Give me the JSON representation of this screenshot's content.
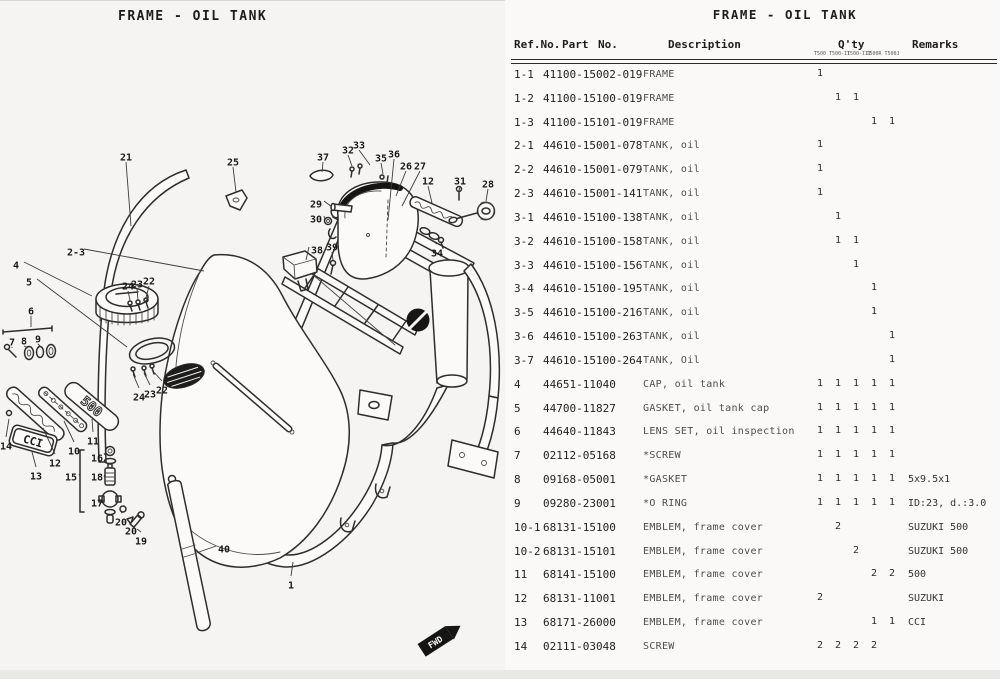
{
  "diagram": {
    "title": "FRAME - OIL TANK",
    "fwd_label": "FWD",
    "emblems": {
      "plate_500": "500",
      "plate_cci": "CCI"
    },
    "callouts": [
      {
        "label": "21",
        "x": 126,
        "y": 157,
        "tx": 131,
        "ty": 226
      },
      {
        "label": "25",
        "x": 233,
        "y": 162,
        "tx": 236,
        "ty": 192
      },
      {
        "label": "37",
        "x": 323,
        "y": 157,
        "tx": 322,
        "ty": 172
      },
      {
        "label": "32",
        "x": 348,
        "y": 150,
        "tx": 352,
        "ty": 166
      },
      {
        "label": "33",
        "x": 359,
        "y": 145,
        "tx": 370,
        "ty": 165
      },
      {
        "label": "35",
        "x": 381,
        "y": 158,
        "tx": 383,
        "ty": 174
      },
      {
        "label": "36",
        "x": 394,
        "y": 154,
        "tx": 388,
        "ty": 220
      },
      {
        "label": "26",
        "x": 406,
        "y": 166,
        "tx": 396,
        "ty": 196
      },
      {
        "label": "27",
        "x": 420,
        "y": 166,
        "tx": 402,
        "ty": 206
      },
      {
        "label": "12",
        "x": 428,
        "y": 181,
        "tx": 432,
        "ty": 203
      },
      {
        "label": "31",
        "x": 460,
        "y": 181,
        "tx": 459,
        "ty": 191
      },
      {
        "label": "28",
        "x": 488,
        "y": 184,
        "tx": 486,
        "ty": 201
      },
      {
        "label": "29",
        "x": 316,
        "y": 204,
        "tx": 332,
        "ty": 207
      },
      {
        "label": "30",
        "x": 316,
        "y": 219,
        "tx": 325,
        "ty": 220
      },
      {
        "label": "38",
        "x": 317,
        "y": 250,
        "tx": 306,
        "ty": 260
      },
      {
        "label": "39",
        "x": 332,
        "y": 247,
        "tx": 333,
        "ty": 260
      },
      {
        "label": "34",
        "x": 437,
        "y": 253,
        "tx": 431,
        "ty": 240
      },
      {
        "label": "2-3",
        "x": 76,
        "y": 252,
        "tx": 204,
        "ty": 271
      },
      {
        "label": "4",
        "x": 16,
        "y": 265,
        "tx": 92,
        "ty": 296
      },
      {
        "label": "5",
        "x": 29,
        "y": 282,
        "tx": 127,
        "ty": 347
      },
      {
        "label": "24",
        "x": 128,
        "y": 286,
        "tx": 130,
        "ty": 300
      },
      {
        "label": "23",
        "x": 137,
        "y": 284,
        "tx": 138,
        "ty": 300
      },
      {
        "label": "22",
        "x": 149,
        "y": 281,
        "tx": 146,
        "ty": 298
      },
      {
        "label": "6",
        "x": 31,
        "y": 311,
        "tx": 31,
        "ty": 327
      },
      {
        "label": "7",
        "x": 12,
        "y": 342,
        "tx": 12,
        "ty": 348
      },
      {
        "label": "8",
        "x": 24,
        "y": 341,
        "tx": 28,
        "ty": 348
      },
      {
        "label": "9",
        "x": 38,
        "y": 339,
        "tx": 41,
        "ty": 347
      },
      {
        "label": "24",
        "x": 139,
        "y": 397,
        "tx": 133,
        "ty": 374
      },
      {
        "label": "23",
        "x": 150,
        "y": 394,
        "tx": 144,
        "ty": 373
      },
      {
        "label": "22",
        "x": 162,
        "y": 390,
        "tx": 152,
        "ty": 370
      },
      {
        "label": "14",
        "x": 6,
        "y": 446,
        "tx": 9,
        "ty": 419
      },
      {
        "label": "12",
        "x": 55,
        "y": 463,
        "tx": 43,
        "ty": 428
      },
      {
        "label": "13",
        "x": 36,
        "y": 476,
        "tx": 32,
        "ty": 452
      },
      {
        "label": "10",
        "x": 74,
        "y": 451,
        "tx": 64,
        "ty": 421
      },
      {
        "label": "11",
        "x": 93,
        "y": 441,
        "tx": 92,
        "ty": 419
      },
      {
        "label": "16",
        "x": 97,
        "y": 458,
        "tx": 104,
        "ty": 453
      },
      {
        "label": "15",
        "x": 71,
        "y": 477,
        "tx": 80,
        "ty": 477
      },
      {
        "label": "18",
        "x": 97,
        "y": 477,
        "tx": 104,
        "ty": 477
      },
      {
        "label": "17",
        "x": 97,
        "y": 503,
        "tx": 101,
        "ty": 500
      },
      {
        "label": "20",
        "x": 121,
        "y": 522,
        "tx": 123,
        "ty": 512
      },
      {
        "label": "20",
        "x": 131,
        "y": 531,
        "tx": 129,
        "ty": 523
      },
      {
        "label": "19",
        "x": 141,
        "y": 541,
        "tx": 137,
        "ty": 529
      },
      {
        "label": "40",
        "x": 224,
        "y": 549,
        "tx": 199,
        "ty": 552
      },
      {
        "label": "1",
        "x": 291,
        "y": 585,
        "tx": 293,
        "ty": 562
      }
    ]
  },
  "table": {
    "title": "FRAME - OIL TANK",
    "headers": {
      "ref": "Ref.No.",
      "part": "Part",
      "no": "No.",
      "description": "Description",
      "qty": "Q'ty",
      "remarks": "Remarks"
    },
    "models": [
      "T500",
      "T500-II",
      "T500-III",
      "T500R",
      "T500J"
    ],
    "rows": [
      {
        "ref": "1-1",
        "part": "41100-15002-019",
        "desc": "FRAME",
        "qty": [
          "1",
          "",
          "",
          "",
          ""
        ],
        "remarks": ""
      },
      {
        "ref": "1-2",
        "part": "41100-15100-019",
        "desc": "FRAME",
        "qty": [
          "",
          "1",
          "1",
          "",
          ""
        ],
        "remarks": ""
      },
      {
        "ref": "1-3",
        "part": "41100-15101-019",
        "desc": "FRAME",
        "qty": [
          "",
          "",
          "",
          "1",
          "1"
        ],
        "remarks": ""
      },
      {
        "ref": "2-1",
        "part": "44610-15001-078",
        "desc": "TANK, oil",
        "qty": [
          "1",
          "",
          "",
          "",
          ""
        ],
        "remarks": ""
      },
      {
        "ref": "2-2",
        "part": "44610-15001-079",
        "desc": "TANK, oil",
        "qty": [
          "1",
          "",
          "",
          "",
          ""
        ],
        "remarks": ""
      },
      {
        "ref": "2-3",
        "part": "44610-15001-141",
        "desc": "TANK, oil",
        "qty": [
          "1",
          "",
          "",
          "",
          ""
        ],
        "remarks": ""
      },
      {
        "ref": "3-1",
        "part": "44610-15100-138",
        "desc": "TANK, oil",
        "qty": [
          "",
          "1",
          "",
          "",
          ""
        ],
        "remarks": ""
      },
      {
        "ref": "3-2",
        "part": "44610-15100-158",
        "desc": "TANK, oil",
        "qty": [
          "",
          "1",
          "1",
          "",
          ""
        ],
        "remarks": ""
      },
      {
        "ref": "3-3",
        "part": "44610-15100-156",
        "desc": "TANK, oil",
        "qty": [
          "",
          "",
          "1",
          "",
          ""
        ],
        "remarks": ""
      },
      {
        "ref": "3-4",
        "part": "44610-15100-195",
        "desc": "TANK, oil",
        "qty": [
          "",
          "",
          "",
          "1",
          ""
        ],
        "remarks": ""
      },
      {
        "ref": "3-5",
        "part": "44610-15100-216",
        "desc": "TANK, oil",
        "qty": [
          "",
          "",
          "",
          "1",
          ""
        ],
        "remarks": ""
      },
      {
        "ref": "3-6",
        "part": "44610-15100-263",
        "desc": "TANK, oil",
        "qty": [
          "",
          "",
          "",
          "",
          "1"
        ],
        "remarks": ""
      },
      {
        "ref": "3-7",
        "part": "44610-15100-264",
        "desc": "TANK, Oil",
        "qty": [
          "",
          "",
          "",
          "",
          "1"
        ],
        "remarks": ""
      },
      {
        "ref": "4",
        "part": "44651-11040",
        "desc": "CAP, oil tank",
        "qty": [
          "1",
          "1",
          "1",
          "1",
          "1"
        ],
        "remarks": ""
      },
      {
        "ref": "5",
        "part": "44700-11827",
        "desc": "GASKET, oil tank cap",
        "qty": [
          "1",
          "1",
          "1",
          "1",
          "1"
        ],
        "remarks": ""
      },
      {
        "ref": "6",
        "part": "44640-11843",
        "desc": "LENS SET, oil inspection",
        "qty": [
          "1",
          "1",
          "1",
          "1",
          "1"
        ],
        "remarks": ""
      },
      {
        "ref": "7",
        "part": "02112-05168",
        "desc": "*SCREW",
        "qty": [
          "1",
          "1",
          "1",
          "1",
          "1"
        ],
        "remarks": ""
      },
      {
        "ref": "8",
        "part": "09168-05001",
        "desc": "*GASKET",
        "qty": [
          "1",
          "1",
          "1",
          "1",
          "1"
        ],
        "remarks": "5x9.5x1"
      },
      {
        "ref": "9",
        "part": "09280-23001",
        "desc": "*O RING",
        "qty": [
          "1",
          "1",
          "1",
          "1",
          "1"
        ],
        "remarks": "ID:23, d.:3.0"
      },
      {
        "ref": "10-1",
        "part": "68131-15100",
        "desc": "EMBLEM, frame cover",
        "qty": [
          "",
          "2",
          "",
          "",
          ""
        ],
        "remarks": "SUZUKI 500"
      },
      {
        "ref": "10-2",
        "part": "68131-15101",
        "desc": "EMBLEM, frame cover",
        "qty": [
          "",
          "",
          "2",
          "",
          ""
        ],
        "remarks": "SUZUKI 500"
      },
      {
        "ref": "11",
        "part": "68141-15100",
        "desc": "EMBLEM, frame cover",
        "qty": [
          "",
          "",
          "",
          "2",
          "2"
        ],
        "remarks": "500"
      },
      {
        "ref": "12",
        "part": "68131-11001",
        "desc": "EMBLEM, frame cover",
        "qty": [
          "2",
          "",
          "",
          "",
          ""
        ],
        "remarks": "SUZUKI"
      },
      {
        "ref": "13",
        "part": "68171-26000",
        "desc": "EMBLEM, frame cover",
        "qty": [
          "",
          "",
          "",
          "1",
          "1"
        ],
        "remarks": "CCI"
      },
      {
        "ref": "14",
        "part": "02111-03048",
        "desc": "SCREW",
        "qty": [
          "2",
          "2",
          "2",
          "2",
          ""
        ],
        "remarks": ""
      }
    ]
  }
}
